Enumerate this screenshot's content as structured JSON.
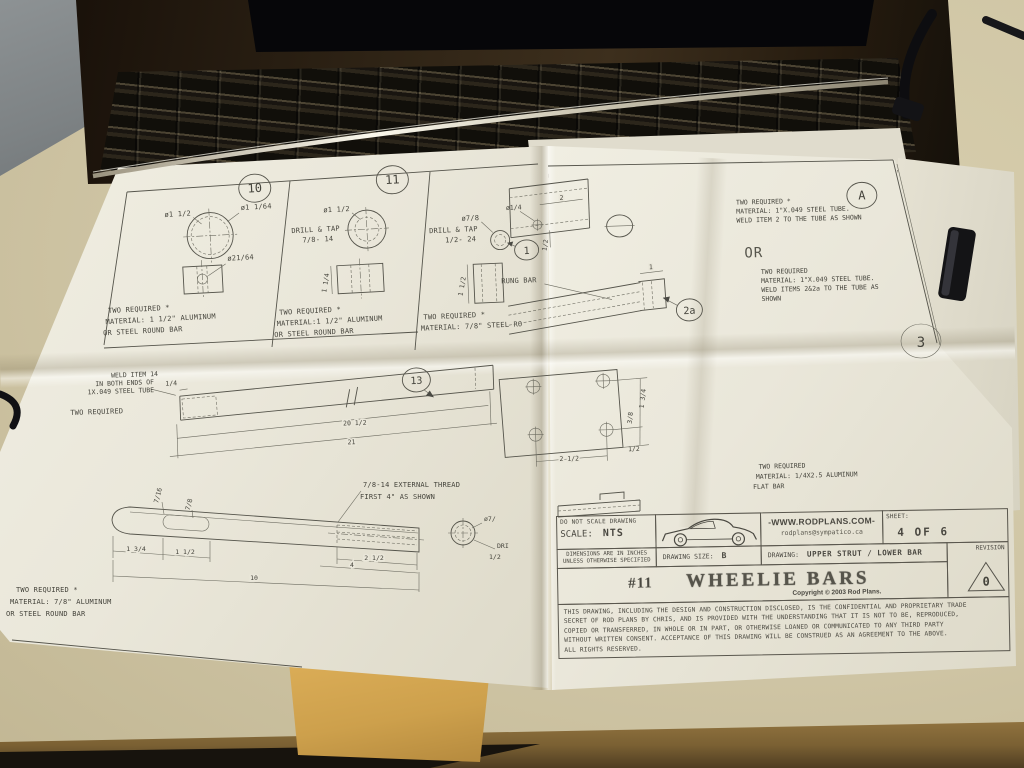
{
  "colors": {
    "paper": "#eae7da",
    "ink": "#4a4a44",
    "desk": "#cfc5a5",
    "desk_edge": "#7a6033",
    "envelope": "#cda04c",
    "laptop_body": "#2e2315",
    "wall": "#7d8284"
  },
  "balloons": {
    "d10": "10",
    "d11": "11",
    "d1": "1",
    "d2a": "2a",
    "d13": "13",
    "dA": "A",
    "back_sheet": "3"
  },
  "d10": {
    "dia_outer": "ø1 1/2",
    "dia_inner": "ø1 1/64",
    "dia_hole": "ø21/64",
    "note": [
      "TWO REQUIRED *",
      "MATERIAL: 1 1/2\" ALUMINUM",
      "OR STEEL ROUND BAR"
    ]
  },
  "d11": {
    "dia": "ø1 1/2",
    "tap1": "DRILL & TAP",
    "tap2": "7/8- 14",
    "height": "1 1/4",
    "note": [
      "TWO REQUIRED *",
      "MATERIAL:1 1/2\" ALUMINUM",
      "OR STEEL ROUND BAR"
    ]
  },
  "d1": {
    "dia": "ø7/8",
    "tap1": "DRILL & TAP",
    "tap2": "1/2- 24",
    "height": "1 1/2",
    "note": [
      "TWO REQUIRED *",
      "MATERIAL: 7/8\" STEEL RO"
    ]
  },
  "upper_tube": {
    "hole_dia": "ø1/4",
    "dim_2": "2",
    "dim_half": "1/2",
    "note_a": [
      "TWO REQUIRED *",
      "MATERIAL: 1\"X.049 STEEL TUBE.",
      "WELD ITEM 2 TO THE TUBE AS SHOWN"
    ],
    "or": "OR",
    "note_b": [
      "TWO REQUIRED",
      "MATERIAL: 1\"X.049 STEEL TUBE.",
      "WELD ITEMS 2&2a TO THE TUBE AS",
      "SHOWN"
    ]
  },
  "rung": {
    "label": "RUNG BAR",
    "dim_1": "1"
  },
  "lower": {
    "weld_note": [
      "WELD ITEM 14",
      "IN BOTH ENDS OF",
      "1X.049 STEEL TUBE"
    ],
    "qty": "TWO REQUIRED",
    "dim_q": "1/4",
    "dim_len1": "20 1/2",
    "dim_len2": "21"
  },
  "plate": {
    "dim_w": "2 1/2",
    "dim_e": "1/2",
    "dim_s": "3/8",
    "dim_h": "1 3/4",
    "note": [
      "TWO REQUIRED",
      "MATERIAL: 1/4X2.5 ALUMINUM",
      "FLAT BAR"
    ]
  },
  "strut": {
    "thread_note1": "7/8-14 EXTERNAL THREAD",
    "thread_note2": "FIRST 4\" AS SHOWN",
    "dim_a": "7/16",
    "dim_b": "7/8",
    "dim_c": "1 3/4",
    "dim_d": "1 1/2",
    "dim_e": "2 1/2",
    "dim_f": "4",
    "dim_len": "10",
    "end_dia": "ø7/",
    "end_tap1": "DRI",
    "end_tap2": "1/2",
    "note": [
      "TWO REQUIRED *",
      "MATERIAL: 7/8\" ALUMINUM",
      "OR STEEL ROUND BAR"
    ]
  },
  "title_block": {
    "do_not_scale": "DO NOT SCALE DRAWING",
    "scale_label": "SCALE:",
    "scale_value": "NTS",
    "website": "-WWW.RODPLANS.COM-",
    "email": "rodplans@sympatico.ca",
    "sheet_label": "SHEET:",
    "sheet_value": "4 OF 6",
    "dims_line1": "DIMENSIONS ARE IN INCHES",
    "dims_line2": "UNLESS OTHERWISE SPECIFIED",
    "size_label": "DRAWING SIZE:",
    "size_value": "B",
    "drawing_label": "DRAWING:",
    "drawing_value": "UPPER STRUT / LOWER BAR",
    "number": "#11",
    "title": "WHEELIE BARS",
    "copyright": "Copyright © 2003 Rod Plans.",
    "revision_label": "REVISION",
    "revision_value": "0",
    "legal": [
      "THIS DRAWING, INCLUDING THE DESIGN AND CONSTRUCTION DISCLOSED, IS THE CONFIDENTIAL AND PROPRIETARY TRADE",
      "SECRET OF ROD PLANS BY CHRIS, AND IS PROVIDED WITH THE UNDERSTANDING THAT IT IS NOT TO BE, REPRODUCED,",
      "COPIED OR TRANSFERRED, IN WHOLE OR IN PART, OR OTHERWISE LOANED OR COMMUNICATED TO ANY THIRD PARTY",
      "WITHOUT WRITTEN CONSENT.  ACCEPTANCE OF THIS DRAWING WILL BE CONSTRUED AS AN AGREEMENT TO THE ABOVE.",
      "ALL RIGHTS RESERVED."
    ]
  }
}
